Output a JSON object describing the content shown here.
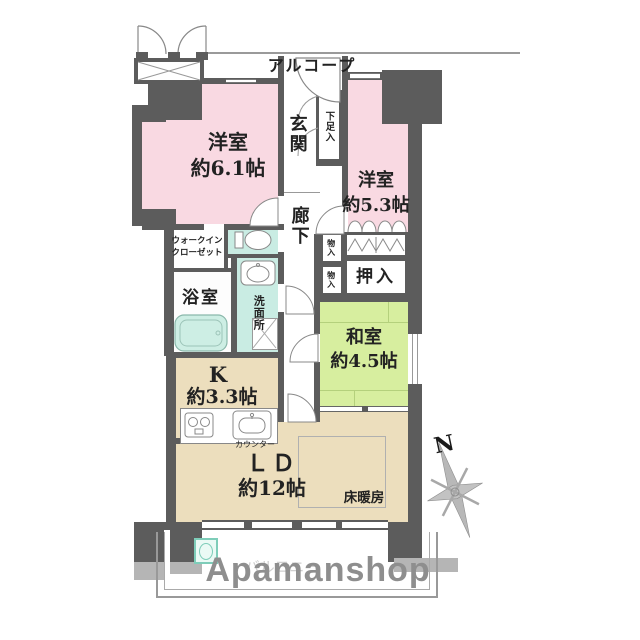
{
  "labels": {
    "alcove": "アルコープ",
    "entrance": "玄関",
    "shoe_box": "下足入",
    "western1_name": "洋室",
    "western1_size": "約6.1帖",
    "western2_name": "洋室",
    "western2_size": "約5.3帖",
    "hallway": "廊下",
    "wic_line1": "ウォークイン",
    "wic_line2": "クローゼット",
    "storage_1": "物入",
    "storage_2": "物入",
    "oshiire": "押入",
    "bathroom": "浴室",
    "washroom": "洗面所",
    "japanese_name": "和室",
    "japanese_size": "約4.5帖",
    "kitchen_name": "K",
    "kitchen_size": "約3.3帖",
    "counter": "カウンター",
    "ld_name": "ＬＤ",
    "ld_size": "約12帖",
    "floor_heating": "床暖房",
    "balcony": "バルコニー",
    "north": "N"
  },
  "watermark": "Apamanshop",
  "colors": {
    "western_room": "#f9d9e2",
    "japanese_room": "#d7ee9f",
    "living_dining": "#ecdebd",
    "wet_area": "#c9ece3",
    "wall_dark": "#5c5c5c",
    "wall_light": "#b5b5b5",
    "watermark_gray": "#8e8e8e"
  }
}
